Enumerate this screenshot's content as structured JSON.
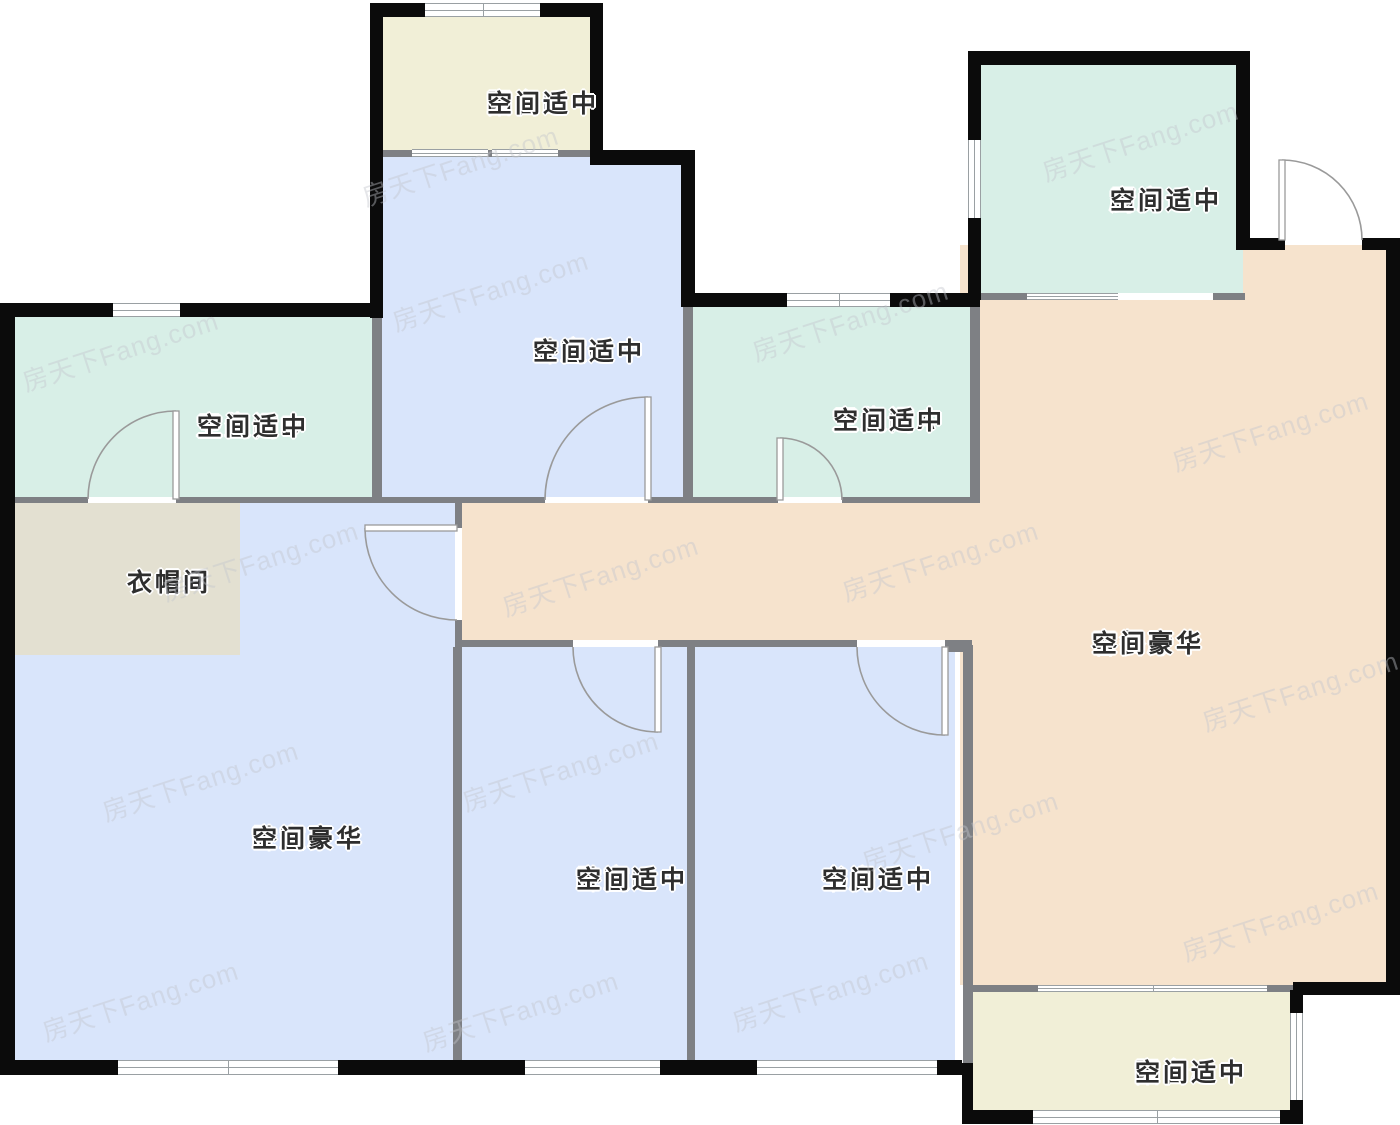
{
  "floorplan": {
    "watermark": "房天下Fang.com",
    "rooms": {
      "balcony_b": {
        "name": "阳台B",
        "size": "空间适中"
      },
      "kitchen": {
        "name": "厨房",
        "size": "空间适中"
      },
      "bedroom_c": {
        "name": "卧室C",
        "size": "空间适中"
      },
      "bathroom_b": {
        "name": "卫生间B",
        "size": "空间适中"
      },
      "bathroom_a": {
        "name": "卫生间A",
        "size": "空间适中"
      },
      "cloakroom": {
        "name": "衣帽间"
      },
      "living_dining": {
        "name": "客餐厅",
        "size": "空间豪华"
      },
      "bedroom_a": {
        "name": "卧室A",
        "size": "空间豪华"
      },
      "bedroom_b": {
        "name": "卧室B",
        "size": "空间适中"
      },
      "study": {
        "name": "书房",
        "size": "空间适中"
      },
      "balcony_a": {
        "name": "阳台A",
        "size": "空间适中"
      }
    },
    "colors": {
      "bedroom_fill": "#d9e5fb",
      "bath_kitchen_fill": "#d8efe7",
      "balcony_fill": "#f1efd7",
      "living_fill": "#f6e3cd",
      "cloakroom_fill": "#e3e0d1",
      "exterior_wall": "#0b0b0b",
      "interior_wall": "#7e8084"
    }
  }
}
